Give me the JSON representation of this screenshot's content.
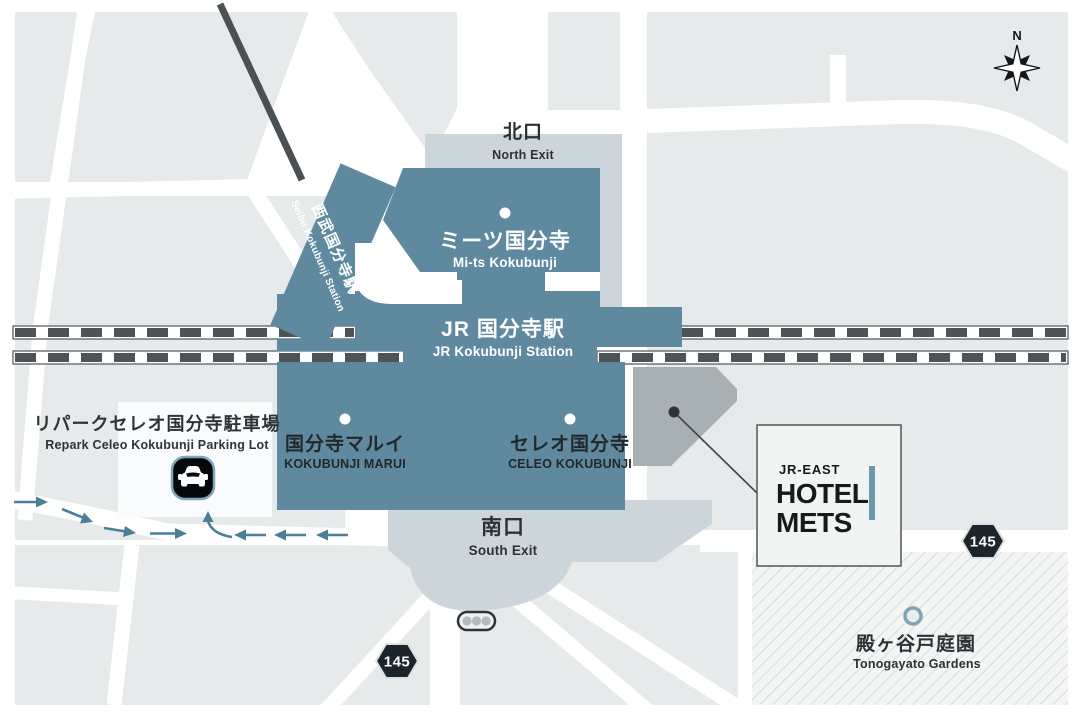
{
  "labels": {
    "north_exit": {
      "jp": "北口",
      "en": "North Exit"
    },
    "mits": {
      "jp": "ミーツ国分寺",
      "en": "Mi-ts Kokubunji"
    },
    "jr_station": {
      "jp": "JR 国分寺駅",
      "en": "JR Kokubunji Station"
    },
    "seibu_station": {
      "jp": "西武国分寺駅",
      "en": "Seibu Kokubunji Station"
    },
    "parking": {
      "jp": "リパークセレオ国分寺駐車場",
      "en": "Repark Celeo Kokubunji Parking Lot"
    },
    "marui": {
      "jp": "国分寺マルイ",
      "en": "KOKUBUNJI MARUI"
    },
    "celeo": {
      "jp": "セレオ国分寺",
      "en": "CELEO KOKUBUNJI"
    },
    "south_exit": {
      "jp": "南口",
      "en": "South Exit"
    },
    "garden": {
      "jp": "殿ヶ谷戸庭園",
      "en": "Tonogayato Gardens"
    },
    "hotel": {
      "brand": "JR-EAST",
      "name1": "HOTEL",
      "name2": "METS"
    },
    "compass_n": "N",
    "route_badges": {
      "south": "145",
      "east": "145"
    }
  },
  "colors": {
    "teal": "#5E899E",
    "plaza": "#CCD6DA",
    "block": "#E7EAEB",
    "darktext": "#2C3135",
    "track": "#4D5357",
    "trackedge": "#5A6064",
    "badge": "#1C252C",
    "arrow": "#4B7F97",
    "accent": "#6D98AB",
    "pentagon": "#A7B0B3",
    "hatchline": "#DCE1E2",
    "railline": "#4A5054"
  }
}
